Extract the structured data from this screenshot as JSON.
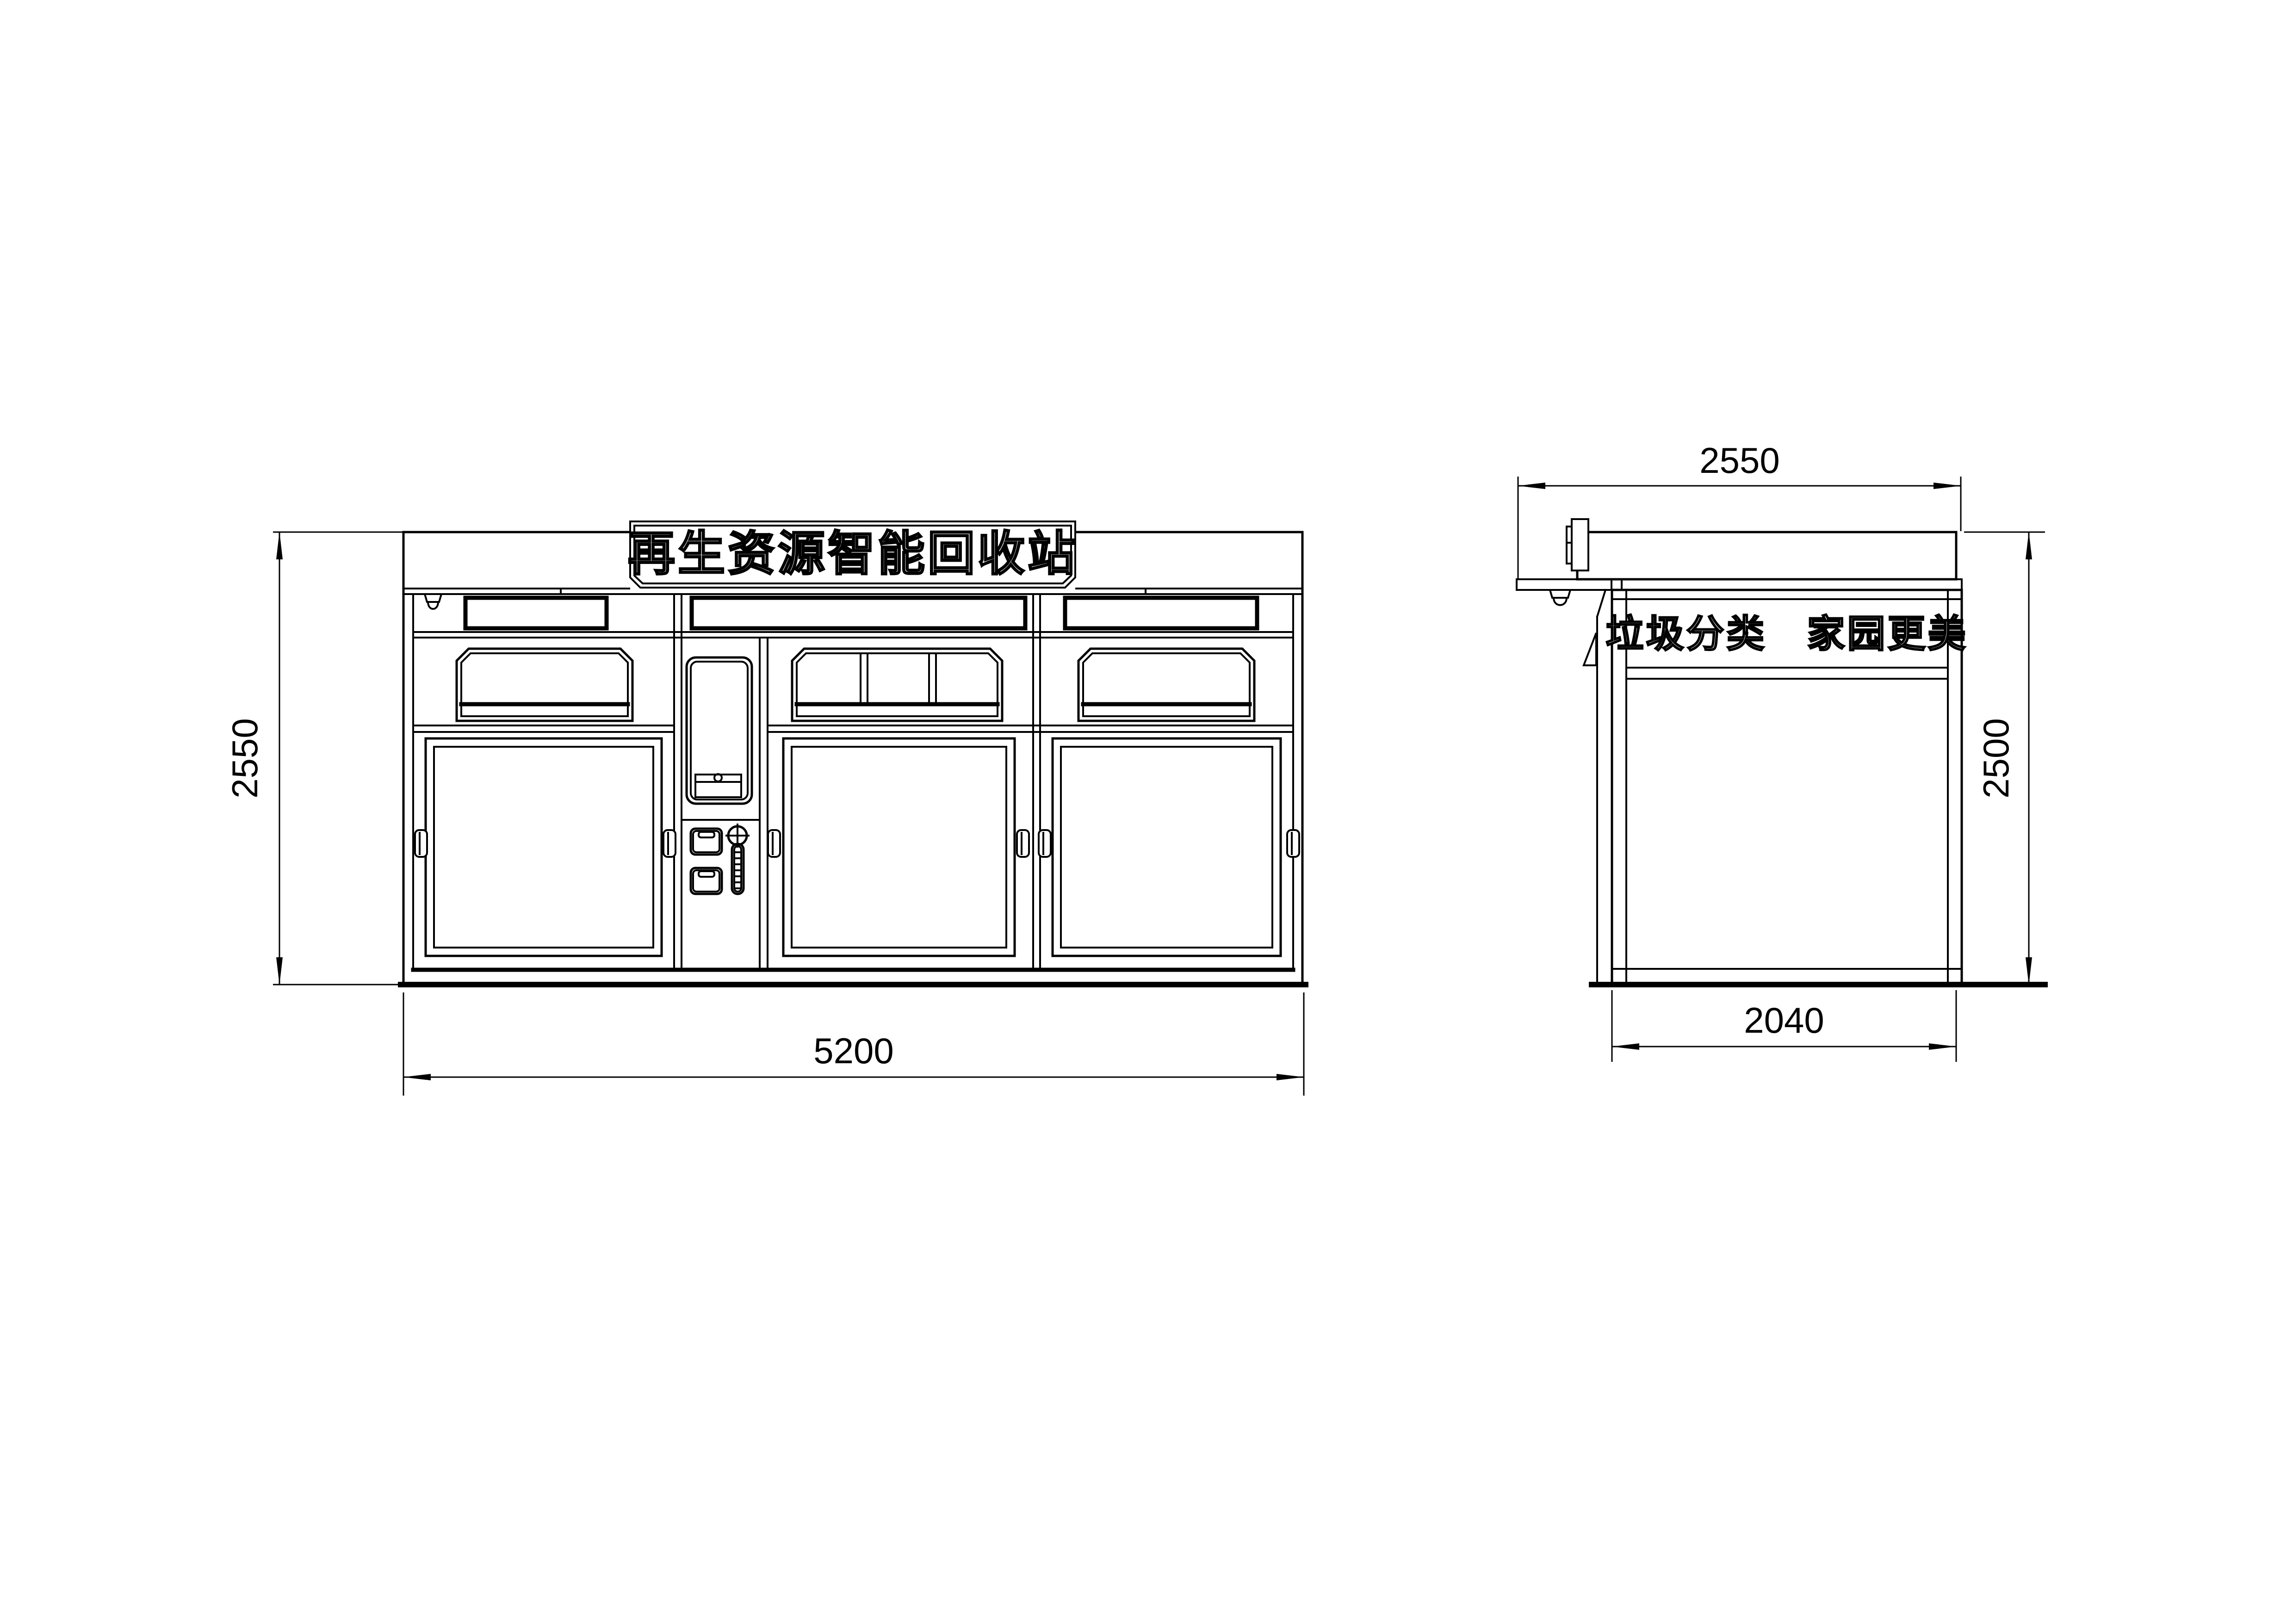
{
  "front_view": {
    "banner_text": "再生资源智能回收站",
    "height_dim": "2550",
    "width_dim": "5200"
  },
  "side_view": {
    "slogan_text": "垃圾分类　家园更美",
    "roof_depth_dim": "2550",
    "height_dim": "2500",
    "body_depth_dim": "2040"
  },
  "colors": {
    "line": "#000000",
    "background": "#ffffff"
  }
}
